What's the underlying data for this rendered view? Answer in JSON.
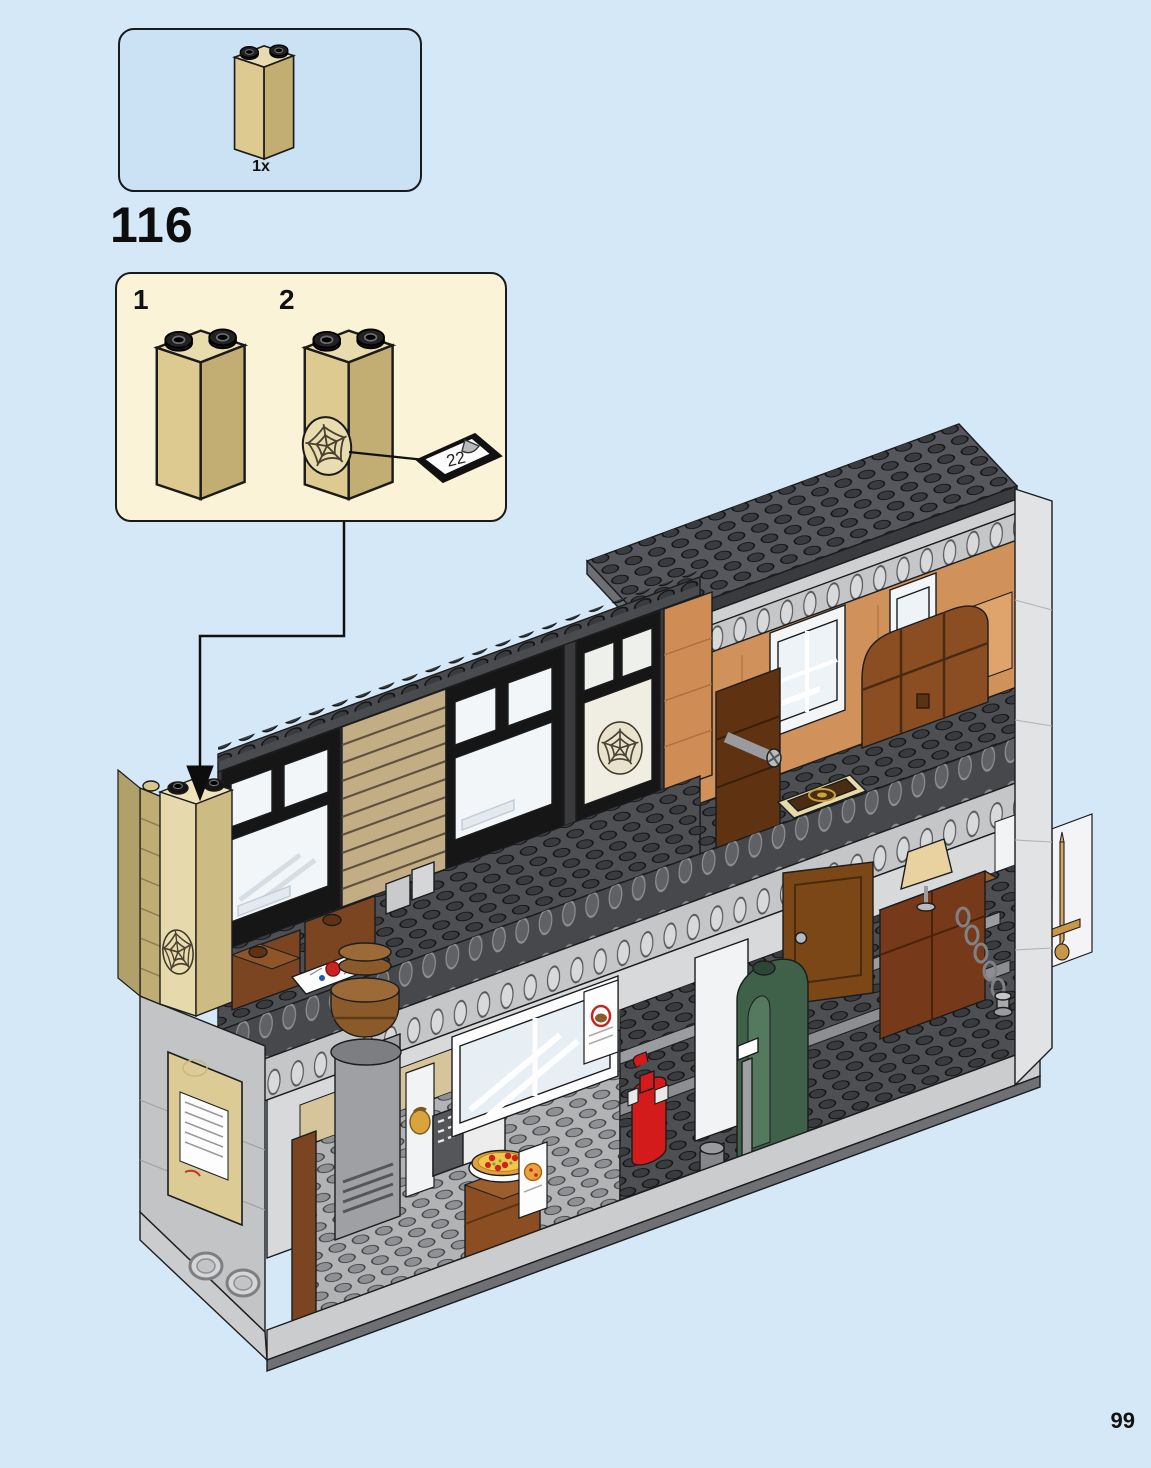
{
  "page": {
    "number": "99",
    "background": "#d5e8f8"
  },
  "step": {
    "number": "116"
  },
  "parts_callout": {
    "quantity_label": "1x",
    "part_icon": "tan-brick-1x2x5-icon"
  },
  "assembly_box": {
    "substep_1_label": "1",
    "substep_2_label": "2",
    "sticker_number": "22",
    "sticker_icon": "sticker-22-icon",
    "web_icon": "spider-web-sticker-icon",
    "pointer_icon": "down-arrow-icon"
  },
  "illustration": {
    "icons": [
      "lego-building-icon",
      "roof-plate-icon",
      "hole-beam-icon",
      "window-icon",
      "sanctum-web-window-icon",
      "treasure-chest-icon",
      "spellbook-tile-icon",
      "bookshelf-icon",
      "comic-tile-icon",
      "door-icon",
      "desk-icon",
      "table-lamp-icon",
      "chain-icon",
      "sword-icon",
      "scroll-icon",
      "boiler-icon",
      "fire-extinguisher-icon",
      "cash-register-icon",
      "pizza-icon",
      "barrel-icon",
      "oven-icon",
      "menu-board-icon",
      "porthole-icon",
      "poster-icon",
      "phone-icon"
    ]
  },
  "palette": {
    "page_bg": "#d5e8f8",
    "callout_bg": "#cbe2f5",
    "substep_bg": "#fbf3d7",
    "outline": "#1a1a1a",
    "tan_light": "#e8dcae",
    "tan_mid": "#d8c58a",
    "tan_dark": "#c0ad74",
    "slat_tan": "#c3ad85",
    "roof_gray": "#55575c",
    "stud_dark": "#3a3b3e",
    "beam_gray": "#c5c6c8",
    "deck_gray": "#4e4f53",
    "wall_gray": "#c3c4c6",
    "nougat": "#d0915a",
    "brown": "#8a4e22",
    "dark_brown": "#5f3312",
    "green": "#3f6149",
    "red": "#d41b1b",
    "gold": "#d9a43c",
    "glass": "#f2f6f9"
  }
}
